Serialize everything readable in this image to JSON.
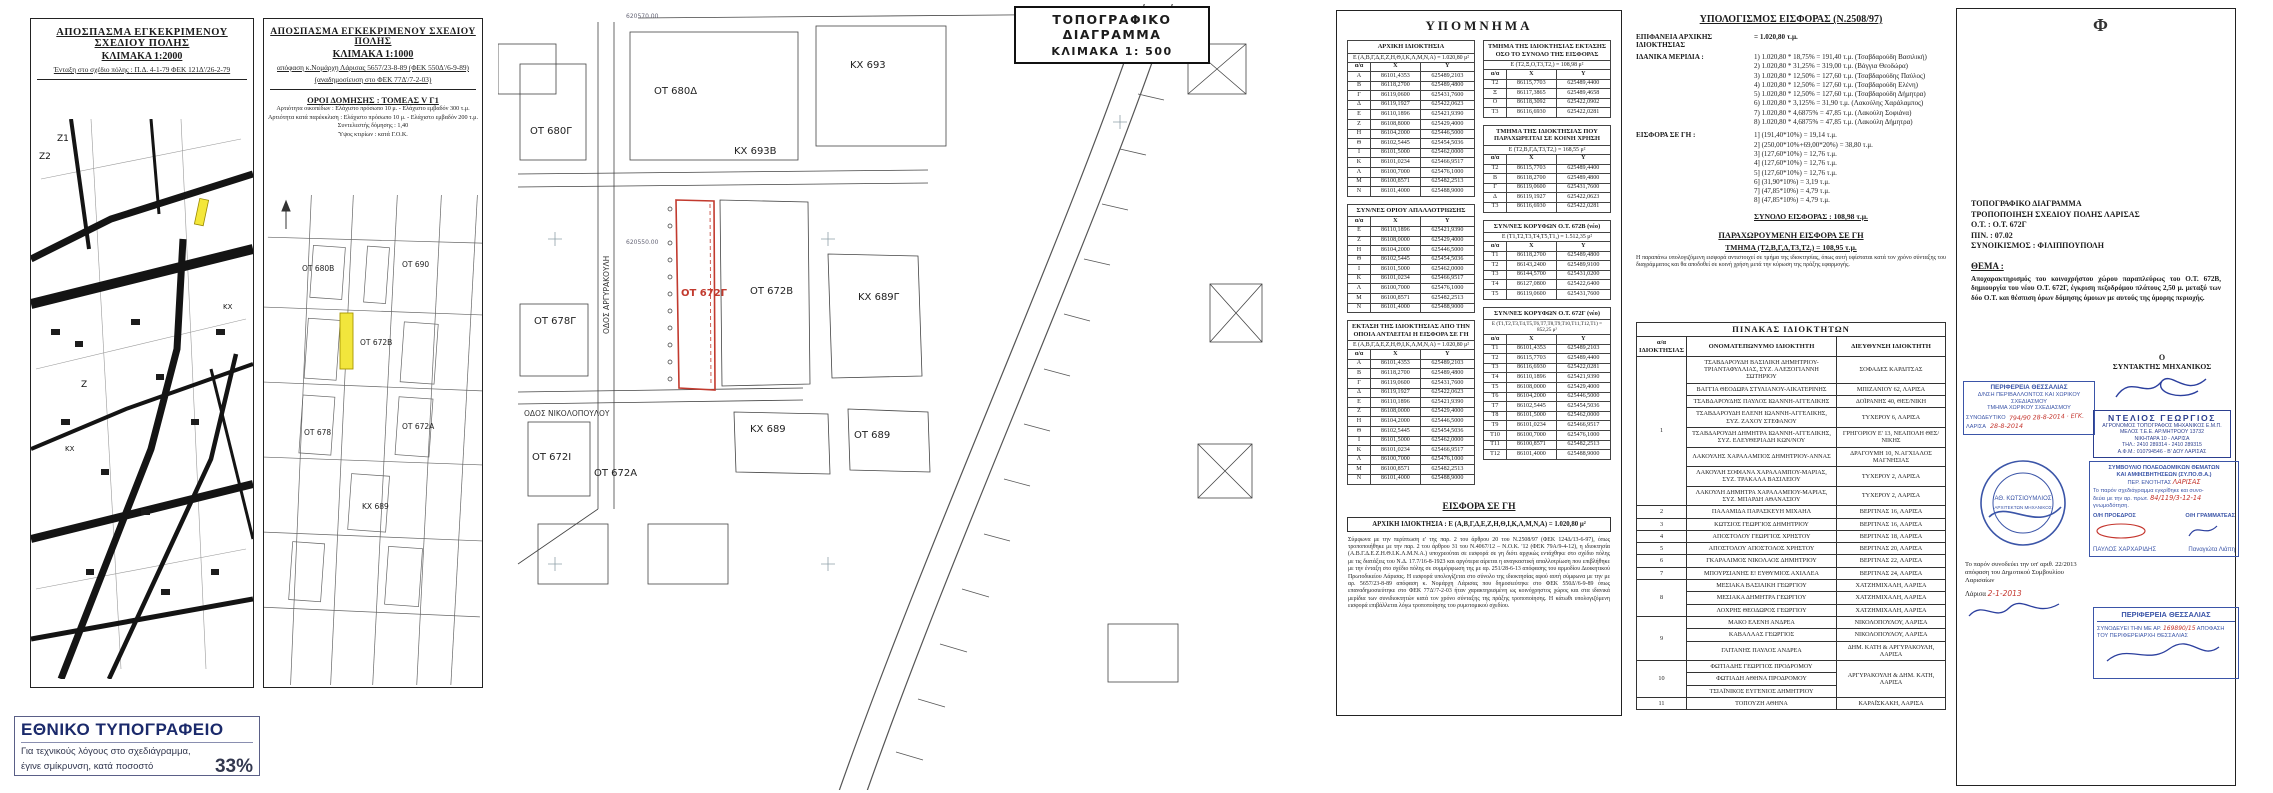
{
  "p1": {
    "title1": "ΑΠΟΣΠΑΣΜΑ ΕΓΚΕΚΡΙΜΕΝΟΥ ΣΧΕΔΙΟΥ ΠΟΛΗΣ",
    "title2": "ΚΛΙΜΑΚΑ 1:2000",
    "subtitle": "Ένταξη στο σχέδιο πόλης : Π.Δ. 4-1-79 ΦΕΚ 121Δ'/26-2-79",
    "labels": [
      "Ζ1",
      "Ζ2",
      "Ζ",
      "ΚΧ",
      "ΚΧ"
    ]
  },
  "printer": {
    "title": "ΕΘΝΙΚΟ ΤΥΠΟΓΡΑΦΕΙΟ",
    "line1": "Για τεχνικούς λόγους στο σχεδιάγραμμα,",
    "line2": "έγινε σμίκρυνση, κατά ποσοστό",
    "pct": "33%"
  },
  "p2": {
    "title1": "ΑΠΟΣΠΑΣΜΑ ΕΓΚΕΚΡΙΜΕΝΟΥ ΣΧΕΔΙΟΥ ΠΟΛΗΣ",
    "title2": "ΚΛΙΜΑΚΑ 1:1000",
    "sub1": "απόφαση κ.Νομάρχη Λάρισας 5657/23-8-89 (ΦΕΚ 550Δ'/6-9-89)",
    "sub2": "(αναδημοσίευση στο ΦΕΚ 77Δ'/7-2-03)",
    "oroi_title": "ΟΡΟΙ ΔΟΜΗΣΗΣ : ΤΟΜΕΑΣ V Γ1",
    "oroi": [
      "Αρτιότητα οικοπέδων : Ελάχιστο πρόσωπο 10 μ. - Ελάχιστο εμβαδόν 300 τ.μ.",
      "Αρτιότητα κατά παρέκκλιση : Ελάχιστο πρόσωπο 10 μ. - Ελάχιστο εμβαδόν 200 τ.μ.",
      "Συντελεστής δόμησης : 1,40",
      "Ύψος κτιρίων : κατά Γ.Ο.Κ."
    ],
    "labels": [
      "ΟΤ 680Β",
      "ΟΤ 690",
      "ΟΤ 672Β",
      "ΟΤ 678",
      "ΟΤ 672Α",
      "ΚΧ 689"
    ]
  },
  "p3": {
    "title1": "ΤΟΠΟΓΡΑΦΙΚΟ ΔΙΑΓΡΑΜΜΑ",
    "title2": "ΚΛΙΜΑΚΑ 1: 500",
    "grid1": "620570.00",
    "grid2": "620550.00",
    "blocks": [
      "ΟΤ 680Δ",
      "ΚΧ 693",
      "ΟΤ 680Γ",
      "ΚΧ 693Β",
      "ΟΤ 672Γ",
      "ΟΤ 672Β",
      "ΚΧ 689Γ",
      "ΟΤ 678Γ",
      "ΟΤ 672Ι",
      "ΟΤ 672Α",
      "ΚΧ 689",
      "ΟΤ 689"
    ],
    "streets": [
      "ΟΔΟΣ ΑΡΓΥΡΑΚΟΥΛΗ",
      "ΟΔΟΣ ΝΙΚΟΛΟΠΟΥΛΟΥ"
    ]
  },
  "legend": {
    "title": "ΥΠΟΜΝΗΜΑ",
    "col_headers": [
      "α/α",
      "X",
      "Y"
    ],
    "t_arxiki": {
      "title": "ΑΡΧΙΚΗ ΙΔΙΟΚΤΗΣΙΑ",
      "area": "Ε (Α,Β,Γ,Δ,Ε,Ζ,Η,Θ,Ι,Κ,Λ,Μ,Ν,Α) = 1.020,80 μ²",
      "rows": [
        [
          "Α",
          "86101,4353",
          "625489,2103"
        ],
        [
          "Β",
          "86118,2700",
          "625489,4800"
        ],
        [
          "Γ",
          "86119,0600",
          "625431,7600"
        ],
        [
          "Δ",
          "86119,1927",
          "625422,0623"
        ],
        [
          "Ε",
          "86110,1896",
          "625421,9390"
        ],
        [
          "Ζ",
          "86108,8000",
          "625429,4000"
        ],
        [
          "Η",
          "86104,2000",
          "625446,5000"
        ],
        [
          "Θ",
          "86102,5445",
          "625454,5036"
        ],
        [
          "Ι",
          "86101,5000",
          "625462,0000"
        ],
        [
          "Κ",
          "86101,0234",
          "625466,9517"
        ],
        [
          "Λ",
          "86100,7000",
          "625476,1000"
        ],
        [
          "Μ",
          "86100,8571",
          "625482,2513"
        ],
        [
          "Ν",
          "86101,4000",
          "625488,9000"
        ]
      ]
    },
    "t_oriou": {
      "title": "ΣΥΝ/ΝΕΣ ΟΡΙΟΥ ΑΠΑΛΛΟΤΡΙΩΣΗΣ",
      "rows": [
        [
          "Ε",
          "86110,1896",
          "625421,9390"
        ],
        [
          "Ζ",
          "86108,0000",
          "625429,4000"
        ],
        [
          "Η",
          "86104,2000",
          "625446,5000"
        ],
        [
          "Θ",
          "86102,5445",
          "625454,5036"
        ],
        [
          "Ι",
          "86101,5000",
          "625462,0000"
        ],
        [
          "Κ",
          "86101,0234",
          "625466,9517"
        ],
        [
          "Λ",
          "86100,7000",
          "625476,1000"
        ],
        [
          "Μ",
          "86100,8571",
          "625482,2513"
        ],
        [
          "Ν",
          "86101,4000",
          "625488,9000"
        ]
      ]
    },
    "t_ektasi": {
      "title": "ΕΚΤΑΣΗ ΤΗΣ ΙΔΙΟΚΤΗΣΙΑΣ ΑΠΟ ΤΗΝ ΟΠΟΙΑ ΑΝΤΛΕΙΤΑΙ Η ΕΙΣΦΟΡΑ ΣΕ ΓΗ",
      "area": "Ε (Α,Β,Γ,Δ,Ε,Ζ,Η,Θ,Ι,Κ,Λ,Μ,Ν,Α) = 1.020,80 μ²",
      "rows": [
        [
          "Α",
          "86101,4353",
          "625489,2103"
        ],
        [
          "Β",
          "86118,2700",
          "625489,4800"
        ],
        [
          "Γ",
          "86119,0600",
          "625431,7600"
        ],
        [
          "Δ",
          "86119,1927",
          "625422,0623"
        ],
        [
          "Ε",
          "86110,1896",
          "625421,9390"
        ],
        [
          "Ζ",
          "86108,0000",
          "625429,4000"
        ],
        [
          "Η",
          "86104,2000",
          "625446,5000"
        ],
        [
          "Θ",
          "86102,5445",
          "625454,5036"
        ],
        [
          "Ι",
          "86101,5000",
          "625462,0000"
        ],
        [
          "Κ",
          "86101,0234",
          "625466,9517"
        ],
        [
          "Λ",
          "86100,7000",
          "625476,1000"
        ],
        [
          "Μ",
          "86100,8571",
          "625482,2513"
        ],
        [
          "Ν",
          "86101,4000",
          "625488,9000"
        ]
      ]
    },
    "t_tmima": {
      "title": "ΤΜΗΜΑ ΤΗΣ ΙΔΙΟΚΤΗΣΙΑΣ ΕΚΤΑΣΗΣ ΟΣΟ ΤΟ ΣΥΝΟΛΟ ΤΗΣ ΕΙΣΦΟΡΑΣ",
      "area": "Ε (Τ2,Ξ,Ο,Τ3,Τ2,) = 108,98 μ²",
      "rows": [
        [
          "Τ2",
          "86115,7703",
          "625489,4400"
        ],
        [
          "Ξ",
          "86117,3865",
          "625489,4658"
        ],
        [
          "Ο",
          "86118,3092",
          "625422,0902"
        ],
        [
          "Τ3",
          "86116,6930",
          "625422,0281"
        ]
      ]
    },
    "t_koini": {
      "title": "ΤΜΗΜΑ ΤΗΣ ΙΔΙΟΚΤΗΣΙΑΣ ΠΟΥ ΠΑΡΑΧΩΡΕΙΤΑΙ ΣΕ ΚΟΙΝΗ ΧΡΗΣΗ",
      "area": "Ε (Τ2,Β,Γ,Δ,Τ3,Τ2,) = 168,55 μ²",
      "rows": [
        [
          "Τ2",
          "86115,7703",
          "625489,4400"
        ],
        [
          "Β",
          "86118,2700",
          "625489,4800"
        ],
        [
          "Γ",
          "86119,0600",
          "625431,7600"
        ],
        [
          "Δ",
          "86119,1927",
          "625422,0623"
        ],
        [
          "Τ3",
          "86116,6930",
          "625422,0281"
        ]
      ]
    },
    "t_672b": {
      "title": "ΣΥΝ/ΝΕΣ ΚΟΡΥΦΩΝ Ο.Τ. 672Β (νέο)",
      "area": "Ε (Τ1,Τ2,Τ3,Τ4,Τ5,Τ1,) = 1.512,35 μ²",
      "rows": [
        [
          "Τ1",
          "86118,2700",
          "625489,4800"
        ],
        [
          "Τ2",
          "86143,2400",
          "625489,9100"
        ],
        [
          "Τ3",
          "86144,5700",
          "625431,0200"
        ],
        [
          "Τ4",
          "86127,0800",
          "625422,6400"
        ],
        [
          "Τ5",
          "86119,0600",
          "625431,7600"
        ]
      ]
    },
    "t_672g": {
      "title": "ΣΥΝ/ΝΕΣ ΚΟΡΥΦΩΝ Ο.Τ. 672Γ (νέο)",
      "area": "Ε (Τ1,Τ2,Τ3,Τ4,Τ5,Τ6,Τ7,Τ8,Τ9,Τ10,Τ11,Τ12,Τ1) = 852,25 μ²",
      "rows": [
        [
          "Τ1",
          "86101,4353",
          "625489,2103"
        ],
        [
          "Τ2",
          "86115,7703",
          "625489,4400"
        ],
        [
          "Τ3",
          "86116,6930",
          "625422,0281"
        ],
        [
          "Τ4",
          "86110,1896",
          "625421,9390"
        ],
        [
          "Τ5",
          "86108,0000",
          "625429,4000"
        ],
        [
          "Τ6",
          "86104,2000",
          "625446,5000"
        ],
        [
          "Τ7",
          "86102,5445",
          "625454,5036"
        ],
        [
          "Τ8",
          "86101,5000",
          "625462,0000"
        ],
        [
          "Τ9",
          "86101,0234",
          "625466,9517"
        ],
        [
          "Τ10",
          "86100,7000",
          "625476,1000"
        ],
        [
          "Τ11",
          "86100,8571",
          "625482,2513"
        ],
        [
          "Τ12",
          "86101,4000",
          "625488,9000"
        ]
      ]
    },
    "eisfora": {
      "heading": "ΕΙΣΦΟΡΑ ΣΕ ΓΗ",
      "box": "ΑΡΧΙΚΗ ΙΔΙΟΚΤΗΣΙΑ : Ε (Α,Β,Γ,Δ,Ε,Ζ,Η,Θ,Ι,Κ,Λ,Μ,Ν,Α) = 1.020,80 μ²",
      "paragraph": "Σύμφωνα με την περίπτωση ε' της παρ. 2 του άρθρου 20 του Ν.2508/97 (ΦΕΚ 124Δ/13-6-97), όπως τροποποιήθηκε με την παρ. 2 του άρθρου 31 του Ν.4067/12 – Ν.Ο.Κ. '12 (ΦΕΚ 79Α/9-4-12), η ιδιοκτησία (Α.Β.Γ.Δ.Ε.Ζ.Η.Θ.Ι.Κ.Λ.Μ.Ν.Α.) υποχρεούται σε εισφορά σε γη διότι αρχικώς εντάχθηκε στο σχέδιο πόλης με τις διατάξεις του Ν.Δ. 17.7/16-8-1923 και αργότερα αίρεται η αναγκαστική απαλλοτρίωση που επιβλήθηκε με την ένταξη στο σχέδιο πόλης σε συμμόρφωση της με αρ. 251/28-6-13 απόφασης του αρμοδίου Διοικητικού Πρωτοδικείου Λάρισας. Η εισφορά υπολογίζεται στο σύνολο της ιδιοκτησίας αφού αυτή σύμφωνα με την με αρ. 5657/23-8-89 απόφαση κ. Νομάρχη Λάρισας που δημοσιεύτηκε στο ΦΕΚ 550Δ'/6-9-89 όπως επαναδημοσιεύτηκε στο ΦΕΚ 77Δ'/7-2-03 ήταν χαρακτηρισμένη ως κοινόχρηστος χώρος και στα ιδανικά μερίδια των συνιδιοκτητών κατά τον χρόνο σύνταξης της πράξης τροποποίησης. Η κάτωθι υπολογιζόμενη εισφορά επιβάλλεται λόγω τροποποίησης του ρυμοτομικού σχεδίου."
    }
  },
  "calc": {
    "title": "ΥΠΟΛΟΓΙΣΜΟΣ ΕΙΣΦΟΡΑΣ (Ν.2508/97)",
    "surface_label": "ΕΠΙΦΑΝΕΙΑ ΑΡΧΙΚΗΣ ΙΔΙΟΚΤΗΣΙΑΣ",
    "surface_value": "=  1.020,80 τ.μ.",
    "merida_label": "ΙΔΑΝΙΚΑ ΜΕΡΙΔΙΑ   :",
    "merida": [
      "1) 1.020,80 * 18,75% = 191,40 τ.μ. (Τσαβδαρούδη Βασιλική)",
      "2) 1.020,80 * 31,25% = 319,00 τ.μ. (Βάγγια Θεοδώρα)",
      "3) 1.020,80 * 12,50% = 127,60 τ.μ. (Τσαβδαρούδης Παύλος)",
      "4) 1.020,80 * 12,50% = 127,60 τ.μ. (Τσαβδαρούδη Ελένη)",
      "5) 1.020,80 * 12,50% = 127,60 τ.μ. (Τσαβδαρούδη Δήμητρα)",
      "6) 1.020,80 * 3,125% =  31,90 τ.μ. (Λακούλης Χαράλαμπος)",
      "7) 1.020,80 * 4,6875% = 47,85 τ.μ. (Λακούλη Σοφιάνα)",
      "8) 1.020,80 * 4,6875% = 47,85 τ.μ. (Λακούλη Δήμητρα)"
    ],
    "eisfora_label": "ΕΙΣΦΟΡΑ ΣΕ ΓΗ   :",
    "eisfora": [
      "1] (191,40*10%)  =  19,14 τ.μ.",
      "2] (250,00*10%+69,00*20%)  =  38,80 τ.μ.",
      "3] (127,60*10%)  =  12,76 τ.μ.",
      "4] (127,60*10%)  =  12,76 τ.μ.",
      "5] (127,60*10%)  =  12,76 τ.μ.",
      "6] (31,90*10%)  =   3,19 τ.μ.",
      "7] (47,85*10%)  =   4,79 τ.μ.",
      "8] (47,85*10%)  =   4,79 τ.μ."
    ],
    "total": "ΣΥΝΟΛΟ ΕΙΣΦΟΡΑΣ :  108,98 τ.μ.",
    "par_title": "ΠΑΡΑΧΩΡΟΥΜΕΝΗ ΕΙΣΦΟΡΑ ΣΕ ΓΗ",
    "par_value": "ΤΜΗΜΑ (Τ2,Β,Γ,Δ,Τ3,Τ2,) = 108,95 τ.μ.",
    "par_note": "Η παραπάνω υπολογιζόμενη εισφορά αντιστοιχεί σε τμήμα της ιδιοκτησίας, όπως αυτή υφίσταται κατά τον χρόνο σύνταξης του διαγράμματος και θα αποδοθεί σε κοινή χρήση μετά την κύρωση της πράξης εφαρμογής."
  },
  "owners": {
    "title": "ΠΙΝΑΚΑΣ ΙΔΙΟΚΤΗΤΩΝ",
    "headers": [
      "α/α ΙΔΙΟΚΤΗΣΙΑΣ",
      "ΟΝΟΜΑΤΕΠΩΝΥΜΟ ΙΔΙΟΚΤΗΤΗ",
      "ΔΙΕΥΘΥΝΣΗ ΙΔΙΟΚΤΗΤΗ"
    ],
    "groups": [
      {
        "num": "1",
        "entries": [
          {
            "name": "ΤΣΑΒΔΑΡΟΥΔΗ ΒΑΣΙΛΙΚΗ ΔΗΜΗΤΡΙΟΥ-ΤΡΙΑΝΤΑΦΥΛΛΙΑΣ, ΣΥΖ. ΑΛΕΞΟΓΙΑΝΝΗ ΣΩΤΗΡΙΟΥ",
            "addr": "ΣΟΦΑΔΕΣ ΚΑΡΔΙΤΣΑΣ"
          },
          {
            "name": "ΒΑΓΓΙΑ ΘΕΟΔΩΡΑ ΣΤΥΛΙΑΝΟΥ-ΑΙΚΑΤΕΡΙΝΗΣ",
            "addr": "ΜΠΙΖΑΝΙΟΥ 62, ΛΑΡΙΣΑ"
          },
          {
            "name": "ΤΣΑΒΔΑΡΟΥΔΗΣ ΠΑΥΛΟΣ ΙΩΑΝΝΗ-ΑΓΓΕΛΙΚΗΣ",
            "addr": "ΔΟΪΡΑΝΗΣ 40, ΘΕΣ/ΝΙΚΗ"
          },
          {
            "name": "ΤΣΑΒΔΑΡΟΥΔΗ ΕΛΕΝΗ ΙΩΑΝΝΗ-ΑΓΓΕΛΙΚΗΣ, ΣΥΖ. ΖΑΧΟΥ ΣΤΕΦΑΝΟΥ",
            "addr": "ΤΥΧΕΡΟΥ 6, ΛΑΡΙΣΑ"
          },
          {
            "name": "ΤΣΑΒΔΑΡΟΥΔΗ ΔΗΜΗΤΡΑ ΙΩΑΝΝΗ-ΑΓΓΕΛΙΚΗΣ, ΣΥΖ. ΕΛΕΥΘΕΡΙΑΔΗ ΚΩΝ/ΝΟΥ",
            "addr": "ΓΡΗΓΟΡΙΟΥ Ε' 13, ΝΕΑΠΟΛΗ ΘΕΣ/ΝΙΚΗΣ"
          },
          {
            "name": "ΛΑΚΟΥΛΗΣ ΧΑΡΑΛΑΜΠΟΣ ΔΗΜΗΤΡΙΟΥ-ΑΝΝΑΣ",
            "addr": "ΔΡΑΓΟΥΜΗ 10, Ν.ΑΓΧΙΑΛΟΣ ΜΑΓΝΗΣΙΑΣ"
          },
          {
            "name": "ΛΑΚΟΥΛΗ ΣΟΦΙΑΝΑ ΧΑΡΑΛΑΜΠΟΥ-ΜΑΡΙΑΣ, ΣΥΖ. ΤΡΑΚΑΛΑ ΒΑΣΙΛΕΙΟΥ",
            "addr": "ΤΥΧΕΡΟΥ 2, ΛΑΡΙΣΑ"
          },
          {
            "name": "ΛΑΚΟΥΛΗ ΔΗΜΗΤΡΑ ΧΑΡΑΛΑΜΠΟΥ-ΜΑΡΙΑΣ, ΣΥΖ. ΜΠΑΡΔΗ ΑΘΑΝΑΣΙΟΥ",
            "addr": "ΤΥΧΕΡΟΥ 2, ΛΑΡΙΣΑ"
          }
        ]
      },
      {
        "num": "2",
        "entries": [
          {
            "name": "ΠΑΛΑΜΙΔΑ ΠΑΡΑΣΚΕΥΗ ΜΙΧΑΗΛ",
            "addr": "ΒΕΡΓΙΝΑΣ 16, ΛΑΡΙΣΑ"
          }
        ]
      },
      {
        "num": "3",
        "entries": [
          {
            "name": "ΚΩΤΣΙΟΣ ΓΕΩΡΓΙΟΣ ΔΗΜΗΤΡΙΟΥ",
            "addr": "ΒΕΡΓΙΝΑΣ 16, ΛΑΡΙΣΑ"
          }
        ]
      },
      {
        "num": "4",
        "entries": [
          {
            "name": "ΑΠΟΣΤΟΛΟΥ ΓΕΩΡΓΙΟΣ ΧΡΗΣΤΟΥ",
            "addr": "ΒΕΡΓΙΝΑΣ 18, ΛΑΡΙΣΑ"
          }
        ]
      },
      {
        "num": "5",
        "entries": [
          {
            "name": "ΑΠΟΣΤΟΛΟΥ ΑΠΟΣΤΟΛΟΣ ΧΡΗΣΤΟΥ",
            "addr": "ΒΕΡΓΙΝΑΣ 20, ΛΑΡΙΣΑ"
          }
        ]
      },
      {
        "num": "6",
        "entries": [
          {
            "name": "ΓΚΑΡΑΛΙΜΟΣ ΝΙΚΟΛΑΟΣ ΔΗΜΗΤΡΙΟΥ",
            "addr": "ΒΕΡΓΙΝΑΣ 22, ΛΑΡΙΣΑ"
          }
        ]
      },
      {
        "num": "7",
        "entries": [
          {
            "name": "ΜΠΟΥΡΣΙΑΝΗΣ Ε! ΕΥΘΥΜΙΟΣ ΑΧΙΛΛΕΑ",
            "addr": "ΒΕΡΓΙΝΑΣ 24, ΛΑΡΙΣΑ"
          }
        ]
      },
      {
        "num": "8",
        "entries": [
          {
            "name": "ΜΕΣΙΑΚΑ ΒΑΣΙΛΙΚΗ ΓΕΩΡΓΙΟΥ",
            "addr": "ΧΑΤΖΗΜΙΧΑΛΗ, ΛΑΡΙΣΑ"
          },
          {
            "name": "ΜΕΣΙΑΚΑ ΔΗΜΗΤΡΑ ΓΕΩΡΓΙΟΥ",
            "addr": "ΧΑΤΖΗΜΙΧΑΛΗ, ΛΑΡΙΣΑ"
          },
          {
            "name": "ΛΟΧΡΗΣ ΘΕΟΔΩΡΟΣ ΓΕΩΡΓΙΟΥ",
            "addr": "ΧΑΤΖΗΜΙΧΑΛΗ, ΛΑΡΙΣΑ"
          }
        ]
      },
      {
        "num": "9",
        "entries": [
          {
            "name": "ΜΑΚΟ ΕΛΕΝΗ ΑΝΔΡΕΑ",
            "addr": "ΝΙΚΟΛΟΠΟΥΛΟΥ, ΛΑΡΙΣΑ"
          },
          {
            "name": "ΚΑΒΑΛΛΑΣ ΓΕΩΡΓΙΟΣ",
            "addr": "ΝΙΚΟΛΟΠΟΥΛΟΥ, ΛΑΡΙΣΑ"
          },
          {
            "name": "ΓΑΙΤΑΝΗΣ ΠΑΥΛΟΣ ΑΝΔΡΕΑ",
            "addr": "ΔΗΜ. ΚΑΤΗ & ΑΡΓΥΡΑΚΟΥΛΗ, ΛΑΡΙΣΑ"
          }
        ]
      },
      {
        "num": "10",
        "shared_addr": "ΑΡΓΥΡΑΚΟΥΛΗ & ΔΗΜ. ΚΑΤΗ, ΛΑΡΙΣΑ",
        "entries": [
          {
            "name": "ΦΩΤΙΑΔΗΣ ΓΕΩΡΓΙΟΣ ΠΡΟΔΡΟΜΟΥ"
          },
          {
            "name": "ΦΩΤΙΑΔΗ ΑΘΗΝΑ ΠΡΟΔΡΟΜΟΥ"
          },
          {
            "name": "ΤΣΙΑΪΝΙΚΟΣ ΕΥΓΕΝΙΟΣ ΔΗΜΗΤΡΙΟΥ"
          }
        ]
      },
      {
        "num": "11",
        "entries": [
          {
            "name": "ΤΟΠΟΥΖΗ ΑΘΗΝΑ",
            "addr": "ΚΑΡΑΪΣΚΑΚΗ, ΛΑΡΙΣΑ"
          }
        ]
      }
    ]
  },
  "sheet": {
    "phi": "Φ",
    "titleblock": {
      "l1": "ΤΟΠΟΓΡΑΦΙΚΟ ΔΙΑΓΡΑΜΜΑ",
      "l2": "ΤΡΟΠΟΠΟΙΗΣΗ ΣΧΕΔΙΟΥ ΠΟΛΗΣ ΛΑΡΙΣΑΣ",
      "l3": "Ο.Τ. : Ο.Τ. 672Γ",
      "l4": "ΠΙΝ. : 07.02",
      "l5": "ΣΥΝΟΙΚΙΣΜΟΣ : ΦΙΛΙΠΠΟΥΠΟΛΗ"
    },
    "thema_label": "ΘΕΜΑ :",
    "thema_text": "Αποχαρακτηρισμός του κοινοχρήστου χώρου παραπλεύρως του Ο.Τ. 672Β, δημιουργία του νέου Ο.Τ. 672Γ, έγκριση πεζοδρόμου πλάτους 2,50 μ. μεταξύ των δύο Ο.Τ. και θέσπιση όρων δόμησης όμοιων με αυτούς της όμορης περιοχής.",
    "region_stamp": {
      "l1": "ΠΕΡΙΦΕΡΕΙΑ  ΘΕΣΣΑΛΙΑΣ",
      "l2": "Δ/ΝΣΗ ΠΕΡΙΒΑΛΛΟΝΤΟΣ ΚΑΙ ΧΩΡΙΚΟΥ ΣΧΕΔΙΑΣΜΟΥ",
      "l3": "ΤΜΗΜΑ ΧΩΡΙΚΟΥ ΣΧΕΔΙΑΣΜΟΥ",
      "l4": "ΣΥΝΟΔΕΥΤΙΚΟ",
      "hand1": "794/90  28-8-2014 · ΕΓΚ.",
      "l5": "ΛΑΡΙΣΑ",
      "hand2": "28-8-2014"
    },
    "dimos_note": {
      "text": "Το παρόν συνοδεύει την υπ' αριθ. 22/2013 απόφαση του Δημοτικού Συμβουλίου Λαρισαίων",
      "city": "Λάρισα",
      "date": "2-1-2013"
    },
    "syntaktis": {
      "o": "Ο",
      "role": "ΣΥΝΤΑΚΤΗΣ ΜΗΧΑΝΙΚΟΣ",
      "stamp": [
        "ΝΤΕΛΙΟΣ  ΓΕΩΡΓΙΟΣ",
        "ΑΓΡΟΝΟΜΟΣ ΤΟΠΟΓΡΑΦΟΣ ΜΗΧΑΝΙΚΟΣ Ε.Μ.Π.",
        "ΜΕΛΟΣ Τ.Ε.Ε. ΑΡ.ΜΗΤΡΩΟΥ 13732",
        "ΝΙΚΗΤΑΡΑ 10 - ΛΑΡΙΣΑ",
        "ΤΗΛ.: 2410 289314 - 2410 289315",
        "Α.Φ.Μ.: 010794546 - Β' ΔΟΥ ΛΑΡΙΣΑΣ"
      ]
    },
    "sypotha": {
      "l1": "ΣΥΜΒΟΥΛΙΟ ΠΟΛΕΟΔΟΜΙΚΩΝ ΘΕΜΑΤΩΝ",
      "l2": "ΚΑΙ ΑΜΦΙΣΒΗΤΗΣΕΩΝ (ΣΥ.ΠΟ.Θ.Α.)",
      "l3": "ΠΕΡ. ΕΝΟΤΗΤΑΣ",
      "hand_city": "ΛΑΡΙΣΑΣ",
      "l4": "Το παρόν σχεδιάγραμμα εγκρίθηκε και συνο-",
      "l5": "δεύει με την αρ. πρωτ.",
      "hand_num": "84/119/3-12-14",
      "l6": "γνωμοδότηση.",
      "proedros": "Ο/Η ΠΡΟΕΔΡΟΣ",
      "grammateas": "Ο/Η ΓΡΑΜΜΑΤΕΑΣ",
      "name1": "ΠΑΥΛΟΣ ΧΑΡΧΑΡΙΔΗΣ",
      "name2": "Παναγιώτα Λιάπη"
    },
    "perif_stamp": {
      "l1": "ΠΕΡΙΦΕΡΕΙΑ  ΘΕΣΣΑΛΙΑΣ",
      "l2a": "ΣΥΝΟΔΕΥΕΙ ΤΗΝ ΜΕ ΑΡ.",
      "hand": "169890/15",
      "l2b": "ΑΠΟΦΑΣΗ",
      "l3": "ΤΟΥ  ΠΕΡΙΦΕΡΕΙΑΡΧΗ  ΘΕΣΣΑΛΙΑΣ"
    },
    "circ_stamp": {
      "name": "ΑΘ. ΚΩΤΣΙΟΥΜΛΙΟΣ",
      "role": "ΑΡΧΙΤΕΚΤΩΝ ΜΗΧΑΝΙΚΟΣ"
    }
  }
}
